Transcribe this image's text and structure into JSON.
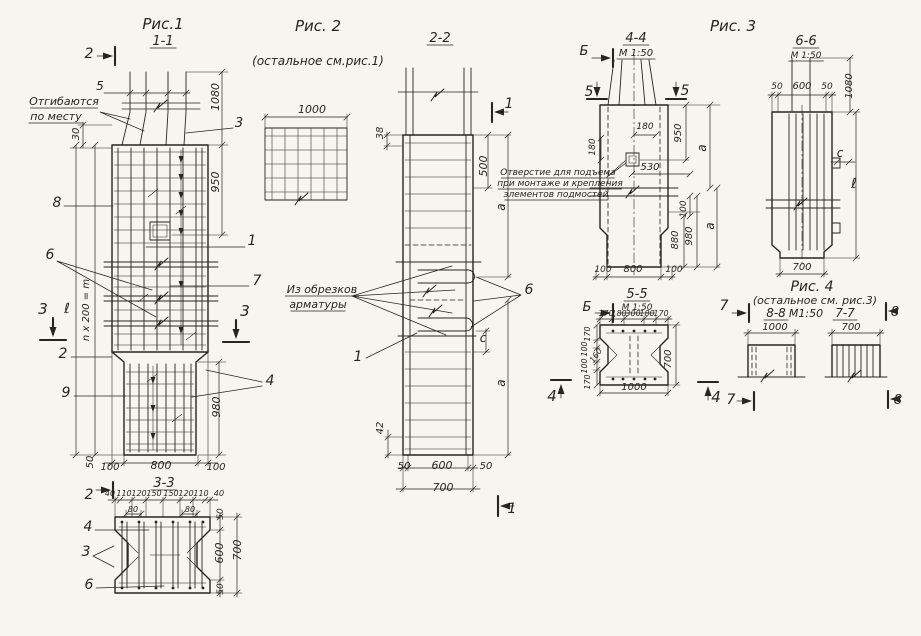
{
  "palette": {
    "ink": "#28251f",
    "paper": "#f7f5f0"
  },
  "drawing_type": "армирование железобетонных колонн — рабочие чертежи",
  "figures": [
    "Рис.1",
    "Рис. 2",
    "Рис. 3",
    "Рис. 4"
  ],
  "sections": [
    "1-1",
    "2-2",
    "3-3",
    "4-4",
    "5-5",
    "6-6",
    "7-7",
    "8-8"
  ],
  "annotations": [
    {
      "n": "fig1-title",
      "t": "Рис.1",
      "x": 163,
      "y": 29,
      "fs": 15
    },
    {
      "n": "fig1-section-label",
      "t": "1-1",
      "x": 163,
      "y": 45,
      "fs": 13,
      "u": 1
    },
    {
      "n": "fig1-cut2-top",
      "t": "2",
      "x": 89,
      "y": 58,
      "fs": 14
    },
    {
      "n": "fig1-dim-5",
      "t": "5",
      "x": 100,
      "y": 90,
      "fs": 12
    },
    {
      "n": "fig1-note-bend-line1",
      "t": "Отгибаются",
      "x": 64,
      "y": 105,
      "fs": 11,
      "u": 1
    },
    {
      "n": "fig1-note-bend-line2",
      "t": "по месту",
      "x": 56,
      "y": 120,
      "fs": 11,
      "u": 1
    },
    {
      "n": "fig1-dim-30",
      "t": "30",
      "x": 79,
      "y": 134,
      "r": -90,
      "fs": 10
    },
    {
      "n": "fig1-dim-1080",
      "t": "1080",
      "x": 219,
      "y": 97,
      "r": -90,
      "fs": 11
    },
    {
      "n": "fig1-pos3-top",
      "t": "3",
      "x": 239,
      "y": 127,
      "fs": 13
    },
    {
      "n": "fig1-dim-950",
      "t": "950",
      "x": 219,
      "y": 182,
      "r": -90,
      "fs": 11
    },
    {
      "n": "fig1-pos8",
      "t": "8",
      "x": 57,
      "y": 207,
      "fs": 14
    },
    {
      "n": "fig1-pos1",
      "t": "1",
      "x": 252,
      "y": 245,
      "fs": 14
    },
    {
      "n": "fig1-pos6",
      "t": "6",
      "x": 50,
      "y": 259,
      "fs": 14
    },
    {
      "n": "fig1-pos7",
      "t": "7",
      "x": 257,
      "y": 285,
      "fs": 14
    },
    {
      "n": "fig1-cut3-left",
      "t": "3",
      "x": 43,
      "y": 314,
      "fs": 15
    },
    {
      "n": "fig1-cut3-right",
      "t": "3",
      "x": 245,
      "y": 316,
      "fs": 15
    },
    {
      "n": "fig1-dim-ell",
      "t": "ℓ",
      "x": 67,
      "y": 313,
      "fs": 14
    },
    {
      "n": "fig1-dim-n200",
      "t": "n x 200 = m",
      "x": 89,
      "y": 310,
      "r": -90,
      "fs": 10
    },
    {
      "n": "fig1-pos2-mid",
      "t": "2",
      "x": 63,
      "y": 358,
      "fs": 14
    },
    {
      "n": "fig1-pos9",
      "t": "9",
      "x": 66,
      "y": 397,
      "fs": 14
    },
    {
      "n": "fig1-pos4",
      "t": "4",
      "x": 270,
      "y": 385,
      "fs": 14
    },
    {
      "n": "fig1-dim-980",
      "t": "980",
      "x": 220,
      "y": 407,
      "r": -90,
      "fs": 11
    },
    {
      "n": "fig1-dim-50-bottom",
      "t": "50",
      "x": 93,
      "y": 462,
      "r": -90,
      "fs": 10
    },
    {
      "n": "fig1-dim-100-left",
      "t": "100",
      "x": 110,
      "y": 470,
      "fs": 10
    },
    {
      "n": "fig1-dim-800",
      "t": "800",
      "x": 161,
      "y": 469,
      "fs": 11
    },
    {
      "n": "fig1-dim-100-right",
      "t": "100",
      "x": 216,
      "y": 470,
      "fs": 10
    },
    {
      "n": "sec33-title",
      "t": "3-3",
      "x": 164,
      "y": 487,
      "fs": 13,
      "u": 1
    },
    {
      "n": "sec33-cut2",
      "t": "2",
      "x": 89,
      "y": 499,
      "fs": 14
    },
    {
      "n": "sec33-dim-40a",
      "t": "40",
      "x": 110,
      "y": 496,
      "fs": 8
    },
    {
      "n": "sec33-dim-110a",
      "t": "110",
      "x": 124,
      "y": 496,
      "fs": 8
    },
    {
      "n": "sec33-dim-120a",
      "t": "120",
      "x": 139,
      "y": 496,
      "fs": 8
    },
    {
      "n": "sec33-dim-150a",
      "t": "150",
      "x": 154,
      "y": 496,
      "fs": 8
    },
    {
      "n": "sec33-dim-150b",
      "t": "150",
      "x": 171,
      "y": 496,
      "fs": 8
    },
    {
      "n": "sec33-dim-120b",
      "t": "120",
      "x": 186,
      "y": 496,
      "fs": 8
    },
    {
      "n": "sec33-dim-110b",
      "t": "110",
      "x": 201,
      "y": 496,
      "fs": 8
    },
    {
      "n": "sec33-dim-40b",
      "t": "40",
      "x": 219,
      "y": 496,
      "fs": 8
    },
    {
      "n": "sec33-dim-80a",
      "t": "80",
      "x": 133,
      "y": 512,
      "fs": 8
    },
    {
      "n": "sec33-dim-80b",
      "t": "80",
      "x": 190,
      "y": 512,
      "fs": 8
    },
    {
      "n": "sec33-dim-50-top",
      "t": "50",
      "x": 223,
      "y": 514,
      "r": -90,
      "fs": 9
    },
    {
      "n": "sec33-pos4",
      "t": "4",
      "x": 88,
      "y": 531,
      "fs": 14
    },
    {
      "n": "sec33-pos3",
      "t": "3",
      "x": 86,
      "y": 556,
      "fs": 14
    },
    {
      "n": "sec33-pos6",
      "t": "6",
      "x": 89,
      "y": 589,
      "fs": 14
    },
    {
      "n": "sec33-dim-600",
      "t": "600",
      "x": 223,
      "y": 553,
      "r": -90,
      "fs": 11
    },
    {
      "n": "sec33-dim-700",
      "t": "700",
      "x": 241,
      "y": 550,
      "r": -90,
      "fs": 11
    },
    {
      "n": "sec33-dim-50-bottom",
      "t": "50",
      "x": 223,
      "y": 589,
      "r": -90,
      "fs": 9
    },
    {
      "n": "fig2-title",
      "t": "Рис. 2",
      "x": 318,
      "y": 31,
      "fs": 15
    },
    {
      "n": "fig2-note",
      "t": "(остальное см.рис.1)",
      "x": 318,
      "y": 65,
      "fs": 12
    },
    {
      "n": "fig2-dim-1000",
      "t": "1000",
      "x": 312,
      "y": 113,
      "fs": 11
    },
    {
      "n": "sec22-title",
      "t": "2-2",
      "x": 440,
      "y": 42,
      "fs": 13,
      "u": 1
    },
    {
      "n": "sec22-dim-38",
      "t": "38",
      "x": 383,
      "y": 133,
      "r": -90,
      "fs": 10
    },
    {
      "n": "sec22-dim-500",
      "t": "500",
      "x": 487,
      "y": 166,
      "r": -90,
      "fs": 11
    },
    {
      "n": "sec22-cut1-top",
      "t": "1",
      "x": 509,
      "y": 108,
      "fs": 14
    },
    {
      "n": "sec22-dim-a-top",
      "t": "a",
      "x": 505,
      "y": 207,
      "r": -90,
      "fs": 12
    },
    {
      "n": "note-offcuts-line1",
      "t": "Из обрезков",
      "x": 322,
      "y": 293,
      "fs": 11,
      "u": 1
    },
    {
      "n": "note-offcuts-line2",
      "t": "арматуры",
      "x": 318,
      "y": 308,
      "fs": 11,
      "u": 1
    },
    {
      "n": "sec22-pos6",
      "t": "6",
      "x": 529,
      "y": 294,
      "fs": 14
    },
    {
      "n": "sec22-dim-c",
      "t": "c",
      "x": 483,
      "y": 342,
      "fs": 12
    },
    {
      "n": "sec22-dim-a-bottom",
      "t": "a",
      "x": 505,
      "y": 383,
      "r": -90,
      "fs": 12
    },
    {
      "n": "sec22-pos1",
      "t": "1",
      "x": 358,
      "y": 361,
      "fs": 14
    },
    {
      "n": "sec22-dim-42",
      "t": "42",
      "x": 383,
      "y": 428,
      "r": -90,
      "fs": 10
    },
    {
      "n": "sec22-dim-50-left",
      "t": "50",
      "x": 404,
      "y": 469,
      "fs": 10
    },
    {
      "n": "sec22-dim-600",
      "t": "600",
      "x": 442,
      "y": 469,
      "fs": 11
    },
    {
      "n": "sec22-dim-50-right",
      "t": "50",
      "x": 486,
      "y": 469,
      "fs": 10
    },
    {
      "n": "sec22-dim-700",
      "t": "700",
      "x": 443,
      "y": 491,
      "fs": 11
    },
    {
      "n": "sec22-cut1-bottom",
      "t": "1",
      "x": 512,
      "y": 513,
      "fs": 14
    },
    {
      "n": "note-hole-line1",
      "t": "Отверстие для подъема",
      "x": 558,
      "y": 175,
      "fs": 9,
      "u": 1
    },
    {
      "n": "note-hole-line2",
      "t": "при монтаже и крепления",
      "x": 560,
      "y": 186,
      "fs": 9,
      "u": 1
    },
    {
      "n": "note-hole-line3",
      "t": "элементов подмостей",
      "x": 556,
      "y": 197,
      "fs": 9,
      "u": 1
    },
    {
      "n": "fig3-title",
      "t": "Рис. 3",
      "x": 733,
      "y": 31,
      "fs": 15
    },
    {
      "n": "sec44-title",
      "t": "4-4",
      "x": 636,
      "y": 42,
      "fs": 13,
      "u": 1
    },
    {
      "n": "sec44-scale",
      "t": "М 1:50",
      "x": 636,
      "y": 56,
      "fs": 10,
      "u": 1
    },
    {
      "n": "sec44-cutB-top",
      "t": "Б",
      "x": 584,
      "y": 55,
      "fs": 13
    },
    {
      "n": "sec44-cut5-left",
      "t": "5",
      "x": 589,
      "y": 96,
      "fs": 14
    },
    {
      "n": "sec44-cut5-right",
      "t": "5",
      "x": 685,
      "y": 95,
      "fs": 14
    },
    {
      "n": "sec44-dim-180h",
      "t": "180",
      "x": 645,
      "y": 129,
      "fs": 9
    },
    {
      "n": "sec44-dim-950",
      "t": "950",
      "x": 681,
      "y": 133,
      "r": -90,
      "fs": 10
    },
    {
      "n": "sec44-dim-180v",
      "t": "180",
      "x": 595,
      "y": 147,
      "r": -90,
      "fs": 9
    },
    {
      "n": "sec44-dim-a-top",
      "t": "a",
      "x": 706,
      "y": 148,
      "r": -90,
      "fs": 12
    },
    {
      "n": "sec44-dim-530",
      "t": "530",
      "x": 650,
      "y": 170,
      "fs": 10
    },
    {
      "n": "sec44-dim-100",
      "t": "100",
      "x": 686,
      "y": 209,
      "r": -90,
      "fs": 9
    },
    {
      "n": "sec44-dim-880",
      "t": "880",
      "x": 678,
      "y": 240,
      "r": -90,
      "fs": 10
    },
    {
      "n": "sec44-dim-980",
      "t": "980",
      "x": 692,
      "y": 236,
      "r": -90,
      "fs": 10
    },
    {
      "n": "sec44-dim-a-bottom",
      "t": "a",
      "x": 714,
      "y": 226,
      "r": -90,
      "fs": 12
    },
    {
      "n": "sec44-dim-100-left",
      "t": "100",
      "x": 603,
      "y": 272,
      "fs": 9
    },
    {
      "n": "sec44-dim-800",
      "t": "800",
      "x": 633,
      "y": 272,
      "fs": 10
    },
    {
      "n": "sec44-dim-100-right",
      "t": "100",
      "x": 674,
      "y": 272,
      "fs": 9
    },
    {
      "n": "sec55-title",
      "t": "5-5",
      "x": 637,
      "y": 298,
      "fs": 13,
      "u": 1
    },
    {
      "n": "sec55-scale",
      "t": "М 1:50",
      "x": 637,
      "y": 310,
      "fs": 9,
      "u": 1
    },
    {
      "n": "sec55-cutB",
      "t": "Б",
      "x": 587,
      "y": 311,
      "fs": 13
    },
    {
      "n": "sec55-cut7",
      "t": "7",
      "x": 724,
      "y": 310,
      "fs": 14
    },
    {
      "n": "sec55-dim-170a",
      "t": "170",
      "x": 606,
      "y": 316,
      "fs": 8
    },
    {
      "n": "sec55-dim-180a",
      "t": "180",
      "x": 619,
      "y": 316,
      "fs": 8
    },
    {
      "n": "sec55-dim-300",
      "t": "300",
      "x": 633,
      "y": 316,
      "fs": 8
    },
    {
      "n": "sec55-dim-180b",
      "t": "180",
      "x": 647,
      "y": 316,
      "fs": 8
    },
    {
      "n": "sec55-dim-170b",
      "t": "170",
      "x": 661,
      "y": 316,
      "fs": 8
    },
    {
      "n": "sec55-dim-170-l1",
      "t": "170",
      "x": 590,
      "y": 334,
      "r": -90,
      "fs": 8
    },
    {
      "n": "sec55-dim-100-l1",
      "t": "100",
      "x": 587,
      "y": 349,
      "r": -90,
      "fs": 8
    },
    {
      "n": "sec55-dim-160",
      "t": "160",
      "x": 598,
      "y": 357,
      "r": -55,
      "fs": 8
    },
    {
      "n": "sec55-dim-100-l2",
      "t": "100",
      "x": 587,
      "y": 366,
      "r": -90,
      "fs": 8
    },
    {
      "n": "sec55-dim-170-l2",
      "t": "170",
      "x": 590,
      "y": 382,
      "r": -90,
      "fs": 8
    },
    {
      "n": "sec55-dim-700",
      "t": "700",
      "x": 671,
      "y": 359,
      "r": -90,
      "fs": 10
    },
    {
      "n": "sec55-dim-1000",
      "t": "1000",
      "x": 634,
      "y": 390,
      "fs": 10
    },
    {
      "n": "sec55-cut4-left",
      "t": "4",
      "x": 552,
      "y": 401,
      "fs": 15
    },
    {
      "n": "sec55-cut4-right",
      "t": "4",
      "x": 716,
      "y": 402,
      "fs": 15
    },
    {
      "n": "fig4-cut7-bottom",
      "t": "7",
      "x": 731,
      "y": 404,
      "fs": 14
    },
    {
      "n": "sec66-title",
      "t": "6-6",
      "x": 806,
      "y": 45,
      "fs": 13,
      "u": 1
    },
    {
      "n": "sec66-scale",
      "t": "М 1:50",
      "x": 806,
      "y": 58,
      "fs": 9,
      "u": 1
    },
    {
      "n": "sec66-dim-50a",
      "t": "50",
      "x": 777,
      "y": 89,
      "fs": 9
    },
    {
      "n": "sec66-dim-600",
      "t": "600",
      "x": 802,
      "y": 89,
      "fs": 10
    },
    {
      "n": "sec66-dim-50b",
      "t": "50",
      "x": 827,
      "y": 89,
      "fs": 9
    },
    {
      "n": "sec66-dim-1080",
      "t": "1080",
      "x": 852,
      "y": 86,
      "r": -90,
      "fs": 10
    },
    {
      "n": "sec66-dim-c",
      "t": "c",
      "x": 840,
      "y": 157,
      "fs": 12
    },
    {
      "n": "sec66-dim-ell",
      "t": "ℓ",
      "x": 854,
      "y": 188,
      "fs": 14
    },
    {
      "n": "sec66-dim-700",
      "t": "700",
      "x": 802,
      "y": 270,
      "fs": 10
    },
    {
      "n": "fig4-title",
      "t": "Рис. 4",
      "x": 812,
      "y": 291,
      "fs": 14
    },
    {
      "n": "fig4-note",
      "t": "(остальное см. рис.3)",
      "x": 815,
      "y": 304,
      "fs": 11
    },
    {
      "n": "sec88-title",
      "t": "8-8",
      "x": 776,
      "y": 317,
      "fs": 12,
      "u": 1
    },
    {
      "n": "sec88-dim-1000",
      "t": "1000",
      "x": 775,
      "y": 330,
      "fs": 10
    },
    {
      "n": "fig4-scale",
      "t": "М1:50",
      "x": 806,
      "y": 317,
      "fs": 11
    },
    {
      "n": "sec77-title",
      "t": "7-7",
      "x": 845,
      "y": 317,
      "fs": 12,
      "u": 1
    },
    {
      "n": "sec77-dim-700",
      "t": "700",
      "x": 851,
      "y": 330,
      "fs": 10
    },
    {
      "n": "fig4-cut8-top",
      "t": "8",
      "x": 895,
      "y": 316,
      "fs": 13
    },
    {
      "n": "fig4-cut8-bottom",
      "t": "8",
      "x": 898,
      "y": 404,
      "fs": 13
    }
  ]
}
